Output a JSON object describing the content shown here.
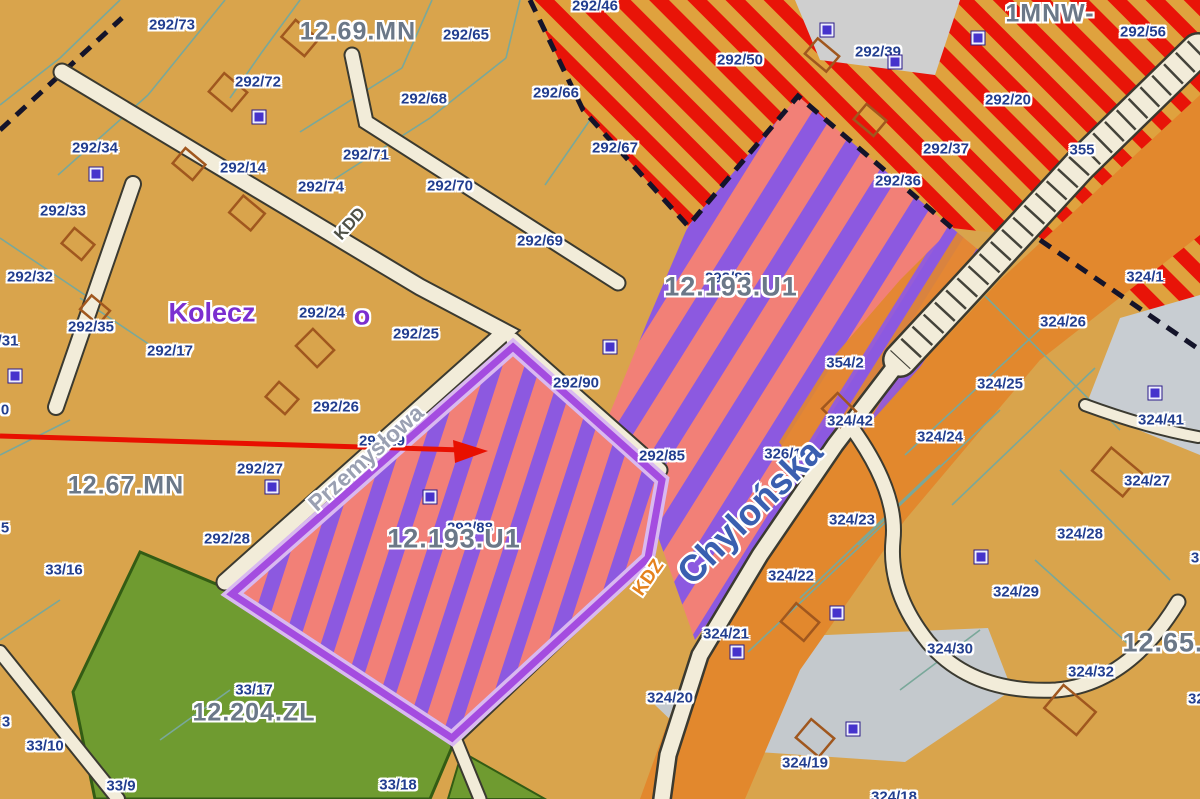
{
  "map": {
    "type": "zoning-plan-map",
    "colors": {
      "parcel_background": "#d9a44c",
      "red_zone_stripe": "#e81408",
      "red_zone_base": "#dfa23e",
      "mixed_zone_pink": "#f28077",
      "mixed_zone_purple": "#8c59e0",
      "highlight_outline": "#a44ce0",
      "forest_zone_green": "#6f9b30",
      "road_corridor_orange": "#e2882d",
      "road_fill_cream": "#f2ecd9",
      "parcel_line_teal": "#79a89a",
      "label_navy": "#223e8f",
      "zone_label_gray": "#6b7888",
      "arrow_red": "#e81000"
    },
    "labels": {
      "parcels": [
        {
          "t": "292/73",
          "x": 172,
          "y": 25
        },
        {
          "t": "292/65",
          "x": 466,
          "y": 35
        },
        {
          "t": "292/72",
          "x": 258,
          "y": 82
        },
        {
          "t": "292/68",
          "x": 424,
          "y": 99
        },
        {
          "t": "292/66",
          "x": 556,
          "y": 93
        },
        {
          "t": "292/46",
          "x": 595,
          "y": 6
        },
        {
          "t": "292/50",
          "x": 740,
          "y": 60
        },
        {
          "t": "292/39",
          "x": 878,
          "y": 52
        },
        {
          "t": "292/56",
          "x": 1143,
          "y": 32
        },
        {
          "t": "292/20",
          "x": 1008,
          "y": 100
        },
        {
          "t": "292/34",
          "x": 95,
          "y": 148
        },
        {
          "t": "292/14",
          "x": 243,
          "y": 168
        },
        {
          "t": "292/71",
          "x": 366,
          "y": 155
        },
        {
          "t": "292/74",
          "x": 321,
          "y": 187
        },
        {
          "t": "292/70",
          "x": 450,
          "y": 186
        },
        {
          "t": "292/37",
          "x": 946,
          "y": 149
        },
        {
          "t": "292/36",
          "x": 898,
          "y": 181
        },
        {
          "t": "355",
          "x": 1082,
          "y": 150
        },
        {
          "t": "292/33",
          "x": 63,
          "y": 211
        },
        {
          "t": "292/67",
          "x": 615,
          "y": 148
        },
        {
          "t": "292/69",
          "x": 540,
          "y": 241
        },
        {
          "t": "292/32",
          "x": 30,
          "y": 277
        },
        {
          "t": "292/35",
          "x": 91,
          "y": 327
        },
        {
          "t": "/31",
          "x": 8,
          "y": 341
        },
        {
          "t": "292/24",
          "x": 322,
          "y": 313
        },
        {
          "t": "292/25",
          "x": 416,
          "y": 334
        },
        {
          "t": "292/17",
          "x": 170,
          "y": 351
        },
        {
          "t": "292/26",
          "x": 336,
          "y": 407
        },
        {
          "t": "292/27",
          "x": 260,
          "y": 469
        },
        {
          "t": "292/29",
          "x": 382,
          "y": 441
        },
        {
          "t": "292/28",
          "x": 227,
          "y": 539
        },
        {
          "t": "292/90",
          "x": 576,
          "y": 383
        },
        {
          "t": "292/85",
          "x": 662,
          "y": 456
        },
        {
          "t": "292/86",
          "x": 728,
          "y": 278
        },
        {
          "t": "292/88",
          "x": 470,
          "y": 528
        },
        {
          "t": "326/1",
          "x": 783,
          "y": 454
        },
        {
          "t": "354/2",
          "x": 845,
          "y": 363
        },
        {
          "t": "324/1",
          "x": 1145,
          "y": 277
        },
        {
          "t": "324/26",
          "x": 1063,
          "y": 322
        },
        {
          "t": "324/25",
          "x": 1000,
          "y": 384
        },
        {
          "t": "324/24",
          "x": 940,
          "y": 437
        },
        {
          "t": "324/41",
          "x": 1161,
          "y": 420
        },
        {
          "t": "324/42",
          "x": 850,
          "y": 421
        },
        {
          "t": "324/27",
          "x": 1147,
          "y": 481
        },
        {
          "t": "324/23",
          "x": 852,
          "y": 520
        },
        {
          "t": "324/22",
          "x": 791,
          "y": 576
        },
        {
          "t": "324/21",
          "x": 726,
          "y": 634
        },
        {
          "t": "324/20",
          "x": 670,
          "y": 698
        },
        {
          "t": "324/19",
          "x": 805,
          "y": 763
        },
        {
          "t": "324/18",
          "x": 894,
          "y": 797
        },
        {
          "t": "324/28",
          "x": 1080,
          "y": 534
        },
        {
          "t": "324/29",
          "x": 1016,
          "y": 592
        },
        {
          "t": "324/30",
          "x": 950,
          "y": 649
        },
        {
          "t": "324/32",
          "x": 1091,
          "y": 672
        },
        {
          "t": "324/33",
          "x": 1211,
          "y": 699
        },
        {
          "t": "33/16",
          "x": 64,
          "y": 570
        },
        {
          "t": "33/17",
          "x": 254,
          "y": 690
        },
        {
          "t": "33/10",
          "x": 45,
          "y": 746
        },
        {
          "t": "33/9",
          "x": 121,
          "y": 786
        },
        {
          "t": "33/18",
          "x": 398,
          "y": 785
        },
        {
          "t": "0",
          "x": 5,
          "y": 410
        },
        {
          "t": "5",
          "x": 5,
          "y": 528
        },
        {
          "t": "3",
          "x": 6,
          "y": 722
        },
        {
          "t": "3",
          "x": 1195,
          "y": 558
        }
      ],
      "zones": [
        {
          "t": "12.69.MN",
          "x": 358,
          "y": 32,
          "size": 25
        },
        {
          "t": "1MNW-",
          "x": 1050,
          "y": 14,
          "size": 25
        },
        {
          "t": "12.67.MN",
          "x": 126,
          "y": 486,
          "size": 25
        },
        {
          "t": "12.204.ZL",
          "x": 254,
          "y": 713,
          "size": 25
        },
        {
          "t": "12.65.",
          "x": 1163,
          "y": 643,
          "size": 27
        },
        {
          "t": "12.193.U1",
          "x": 731,
          "y": 287,
          "size": 27
        },
        {
          "t": "12.193.U1",
          "x": 454,
          "y": 539,
          "size": 27
        }
      ],
      "streets": [
        {
          "t": "Kolecz",
          "x": 212,
          "y": 313,
          "rot": 0,
          "color": "#7b2fd0",
          "size": 27
        },
        {
          "t": "o",
          "x": 362,
          "y": 316,
          "rot": 0,
          "color": "#7b2fd0",
          "size": 27
        },
        {
          "t": "Przemysłowa",
          "x": 366,
          "y": 458,
          "rot": -42,
          "color": "#9aa0b2",
          "size": 23
        },
        {
          "t": "Chylońska",
          "x": 750,
          "y": 512,
          "rot": -45,
          "color": "#3a5fb0",
          "size": 37
        },
        {
          "t": "KDD",
          "x": 350,
          "y": 224,
          "rot": -48,
          "color": "#4f5147",
          "size": 17
        },
        {
          "t": "KDZ",
          "x": 649,
          "y": 578,
          "rot": -55,
          "color": "#e5821c",
          "size": 19
        }
      ]
    },
    "markers": {
      "address_point_squares": [
        {
          "x": 259,
          "y": 117
        },
        {
          "x": 96,
          "y": 174
        },
        {
          "x": 15,
          "y": 376
        },
        {
          "x": 272,
          "y": 487
        },
        {
          "x": 430,
          "y": 497
        },
        {
          "x": 610,
          "y": 347
        },
        {
          "x": 827,
          "y": 30
        },
        {
          "x": 895,
          "y": 62
        },
        {
          "x": 978,
          "y": 38
        },
        {
          "x": 837,
          "y": 613
        },
        {
          "x": 737,
          "y": 652
        },
        {
          "x": 853,
          "y": 729
        },
        {
          "x": 981,
          "y": 557
        },
        {
          "x": 1155,
          "y": 393
        }
      ]
    },
    "annotation": {
      "arrow": {
        "x1": 0,
        "y1": 436,
        "x2": 462,
        "y2": 450,
        "tip": "488,451 453,440 455,463",
        "color": "#e81000"
      }
    }
  }
}
